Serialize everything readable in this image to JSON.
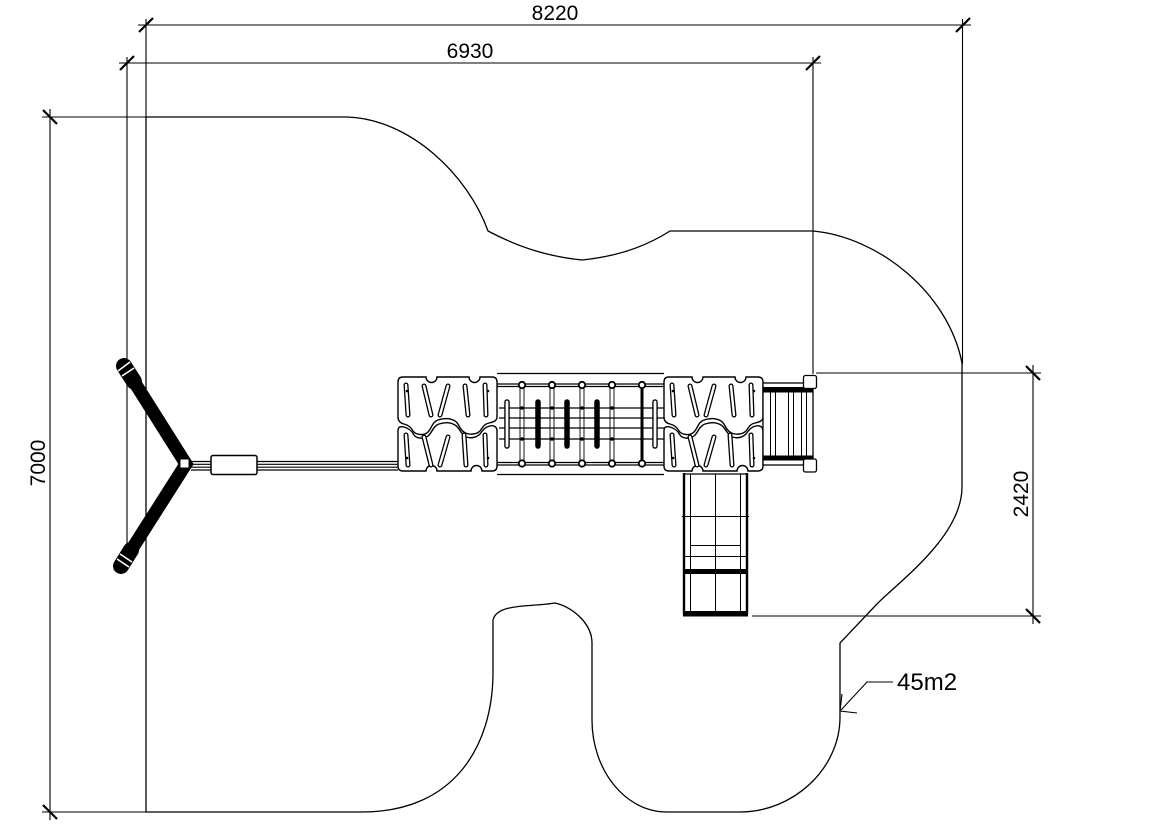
{
  "drawing": {
    "dimensions": {
      "overall_width": "8220",
      "equipment_width": "6930",
      "overall_depth": "7000",
      "slide_zone_depth": "2420"
    },
    "area_label": "45m2",
    "colors": {
      "line": "#000000",
      "background": "#ffffff"
    }
  }
}
